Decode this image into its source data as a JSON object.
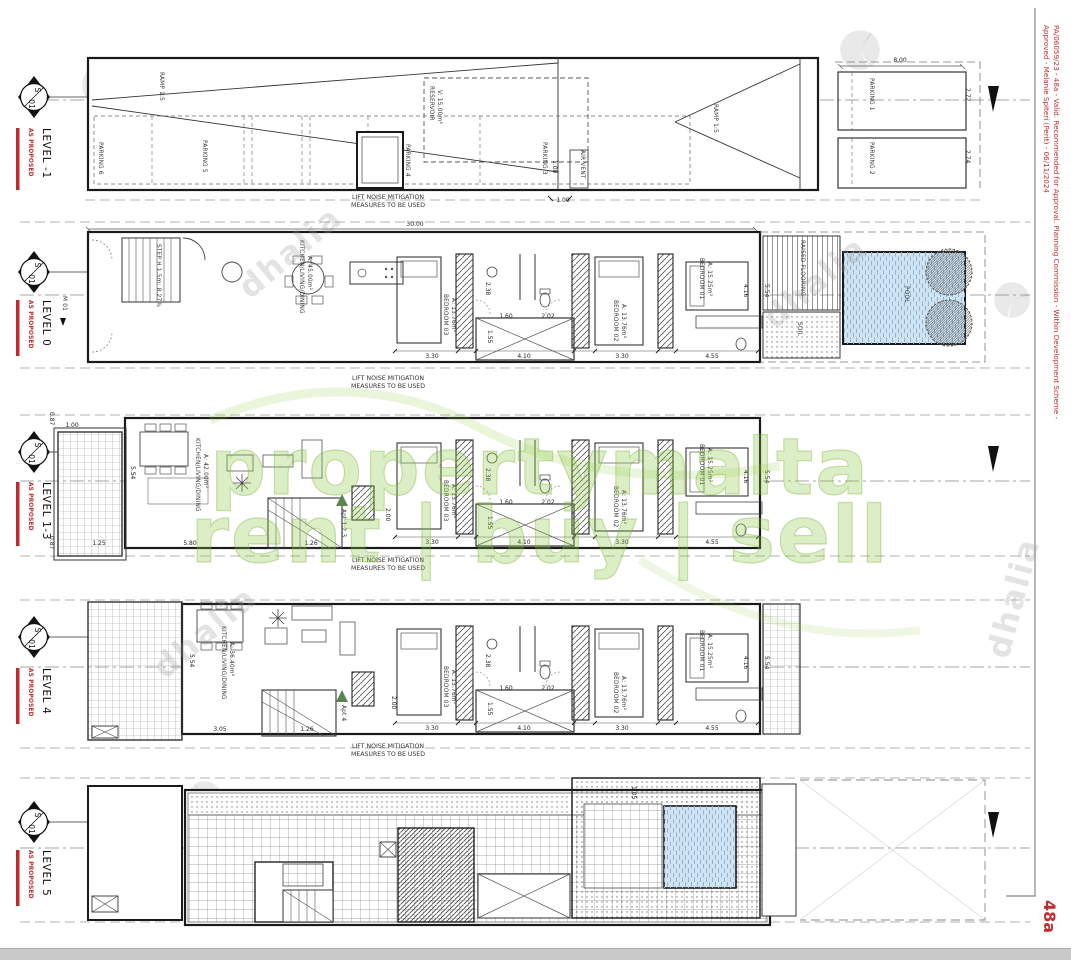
{
  "sheet": {
    "approval_note_line1": "PA/06059/23 - 48a - Valid. Recommended for Approval. Planning Commission - Within Development Scheme -",
    "approval_note_line2": "Approved - Melanie Spiteri (Perit) - 06/11/2024",
    "sheet_number": "48a",
    "marker_top": "S",
    "marker_bottom": "01",
    "status_label": "AS PROPOSED",
    "colors": {
      "status_red": "#c22a2e",
      "pool_blue": "#cfe3f2",
      "watermark_green": "#8bc63e"
    }
  },
  "watermarks": {
    "brand_line1": "propertymalta",
    "brand_line2": "rent | buy | sell",
    "agency": "dhalia"
  },
  "note": {
    "line1": "LIFT NOISE MITIGATION",
    "line2": "MEASURES TO BE USED"
  },
  "core": {
    "bedroom03_name": "BEDROOM 03",
    "bedroom03_area": "A: 13.76m²",
    "bedroom02_name": "BEDROOM 02",
    "bedroom02_area": "A: 13.76m²",
    "bedroom01_name": "BEDROOM 01",
    "bedroom01_area": "A: 15.25m²",
    "dims": {
      "w238": "2.38",
      "w160": "1.60",
      "w202": "2.02",
      "w155": "1.55",
      "w330a": "3.30",
      "w410": "4.10",
      "w330b": "3.30",
      "w455": "4.55",
      "w416": "4.16",
      "w554": "5.54"
    }
  },
  "levels": {
    "minus1": {
      "label": "LEVEL -1",
      "labels": {
        "ramp_left": "RAMP 1:5",
        "ramp_right": "RAMP 1:5",
        "parking1": "PARKING 1",
        "parking2": "PARKING 2",
        "parking3": "PARKING 3",
        "parking4": "PARKING 4",
        "parking5": "PARKING 5",
        "parking6": "PARKING 6",
        "reservoir_line1": "RESERVOIR",
        "reservoir_line2": "V: 15.00m³",
        "air_vent": "AIR VENT"
      },
      "dims": {
        "w800": "8.00",
        "w272": "2.72",
        "w274": "2.74",
        "w100a": "1.00",
        "w100b": "1.00"
      }
    },
    "l0": {
      "label": "LEVEL 0",
      "labels": {
        "m01": "M 01",
        "step": "STEP H 1.5m: 8.27%",
        "kld_name": "KITCHEN/LIVING/DINING",
        "kld_area": "A: 45.00m²",
        "raised_flooring": "RAISED FLOORING",
        "pool": "POOL",
        "soil": "SOIL"
      },
      "dims": {
        "w3000": "30.00"
      }
    },
    "l13": {
      "label": "LEVEL 1-3",
      "labels": {
        "kld_name": "KITCHEN/LIVING/DINING",
        "kld_area": "A: 42.00m²",
        "apt": "Apt 1,2,3"
      },
      "dims": {
        "w100": "1.00",
        "w087a": "0.87",
        "w087b": "0.87",
        "w554": "5.54",
        "w580": "5.80",
        "w125": "1.25",
        "w126": "1.26",
        "w200": "2.00"
      }
    },
    "l4": {
      "label": "LEVEL 4",
      "labels": {
        "kld_name": "KITCHEN/LIVING/DINING",
        "kld_area": "A: 36.40m²",
        "apt": "Apt 4"
      },
      "dims": {
        "w554": "5.54",
        "w305": "3.05",
        "w126": "1.26",
        "w200": "2.00"
      }
    },
    "l5": {
      "label": "LEVEL 5",
      "dims": {
        "w105": "1.05"
      }
    }
  }
}
